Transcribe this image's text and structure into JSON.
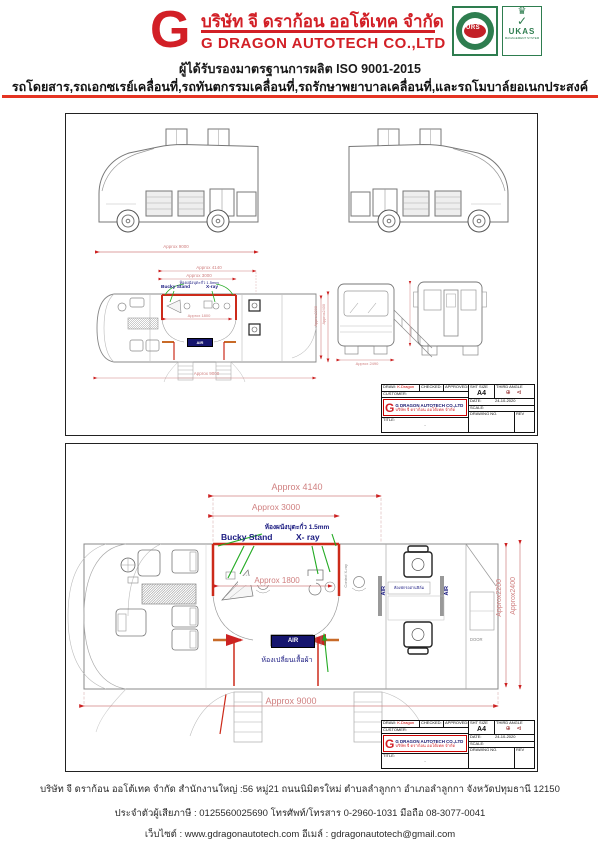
{
  "header": {
    "logo_letter": "G",
    "company_name_th": "บริษัท จี ดราก้อน ออโต้เทค จำกัด",
    "company_name_en": "G DRAGON AUTOTECH CO.,LTD",
    "iso_line": "ผู้ได้รับรองมาตรฐานการผลิต  ISO 9001-2015",
    "services_line": "รถโดยสาร,รถเอกซเรย์เคลื่อนที่,รถทันตกรรมเคลื่อนที่,รถรักษาพยาบาลเคลื่อนที่,และรถโมบาล์ยอเนกประสงค์",
    "badge_urs": "URS",
    "badge_ukas": "UKAS",
    "badge_ukas_sub": "MANAGEMENT SYSTEM"
  },
  "titleblock": {
    "draw_label": "DRAW:",
    "draw_value": "K.Dragon",
    "checked_label": "CHECKED:",
    "approved_label": "APPROVED:",
    "customer_label": "CUSTOMER:",
    "logo_letter": "G",
    "company_en": "G DRAGON AUTOTECH CO.,LTD",
    "company_th": "บริษัท จี ดราก้อน ออโต้เทค จำกัด",
    "sht_size_label": "SHT SIZE",
    "sht_size_value": "A4",
    "third_angle_label": "THIRD ANGLE",
    "third_angle_symbols": "⊕ ⊲",
    "date_label": "DATE:",
    "date_value": "24-10-2020",
    "scale_label": "SCALE:",
    "title_label": "TITLE:",
    "title_value": "-",
    "drawing_no_label": "DRAWING NO.",
    "rev_label": "REV"
  },
  "drawing1": {
    "dim_side_length": "Approx 9000",
    "dim_plan_top": "Approx 4140",
    "dim_plan_inner": "Approx 3000",
    "dim_room": "Approx 1800",
    "dim_plan_bottom": "Approx 9000",
    "dim_rear_width": "Approx 2490",
    "dim_height_inner": "Approx2200",
    "dim_height_outer": "Approx2400",
    "label_lead_wall": "ห้องผนังบุตะกั่ว 1.5mm",
    "label_bucky": "Bucky Stand",
    "label_xray": "X-ray",
    "label_air": "AIR"
  },
  "drawing2": {
    "dim_top": "Approx 4140",
    "dim_inner": "Approx 3000",
    "dim_room": "Approx 1800",
    "dim_bottom": "Approx 9000",
    "dim_width_inner": "Approx2200",
    "dim_width_outer": "Approx2400",
    "label_lead_wall": "ห้องผนังบุตะกั่ว 1.5mm",
    "label_bucky": "Bucky Stand",
    "label_xray": "X- ray",
    "label_air": "AIR",
    "label_door": "DOOR",
    "label_control": "Control X-ray",
    "label_waiting_room": "ห้องพักรออ่านฟิล์ม",
    "label_changing_room": "ห้องเปลี่ยนเสื้อผ้า"
  },
  "footer": {
    "line1": "บริษัท จี ดราก้อน ออโต้เทค จำกัด สำนักงานใหญ่ :56 หมู่21 ถนนนิมิตรใหม่ ตำบลลำลูกกา อำเภอลำลูกกา จังหวัดปทุมธานี 12150",
    "line2": "ประจำตัวผู้เสียภาษี : 0125560025690  โทรศัพท์/โทรสาร 0-2960-1031 มือถือ 08-3077-0041",
    "line3": "เว็บไซต์ : www.gdragonautotech.com  อีเมล์ : gdragonautotech@gmail.com"
  },
  "colors": {
    "brand_red": "#d21f26",
    "rule_red": "#e53422",
    "dim_pink": "#d08080",
    "arrow_red": "#cc2222",
    "room_red": "#cc2a1a",
    "wall_orange": "#c86a28",
    "label_navy": "#1a1a80",
    "leader_green": "#22aa22",
    "badge_green": "#2e7d4f"
  }
}
